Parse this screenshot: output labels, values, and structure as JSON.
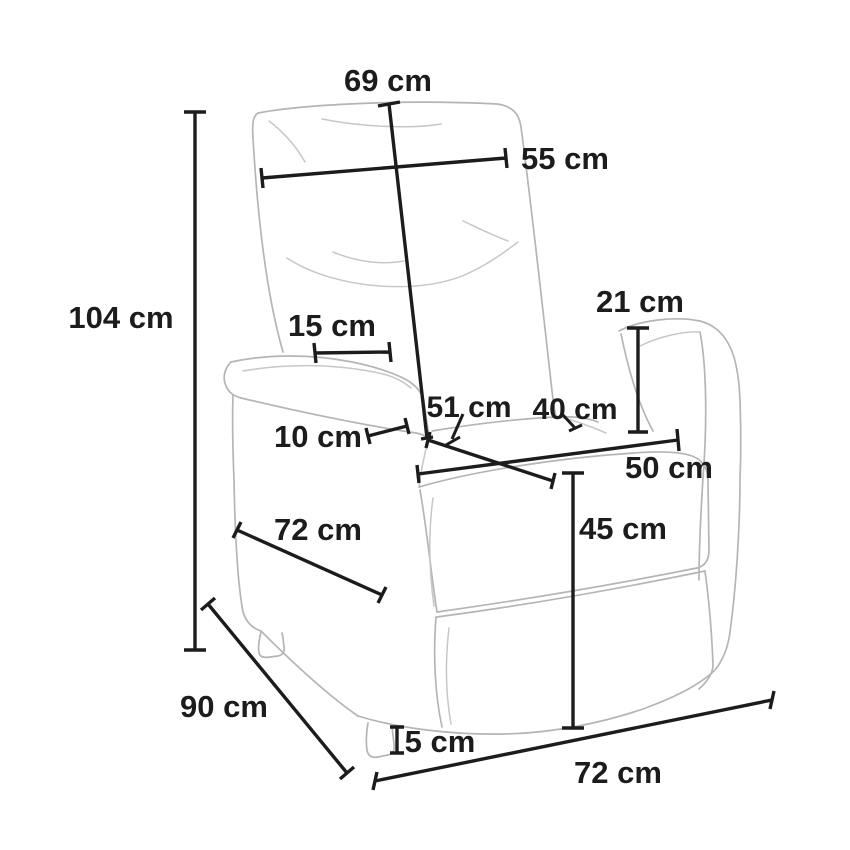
{
  "diagram": {
    "type": "product-dimension-diagram",
    "subject": "recliner armchair line drawing with measurements",
    "unit": "cm",
    "labels": {
      "overall_height": "104 cm",
      "backrest_length": "69 cm",
      "backrest_width": "55 cm",
      "armrest_top_length": "15 cm",
      "armrest_width": "10 cm",
      "armrest_height": "21 cm",
      "seat_depth": "51 cm",
      "seat_inner_width": "40 cm",
      "seat_front_width": "50 cm",
      "seat_height": "45 cm",
      "base_side_depth": "72 cm",
      "overall_depth": "90 cm",
      "foot_height": "5 cm",
      "base_front_width": "72 cm"
    },
    "colors": {
      "background": "#ffffff",
      "dimension_lines": "#1c1c1c",
      "chair_outline": "#b5b5b5"
    }
  }
}
